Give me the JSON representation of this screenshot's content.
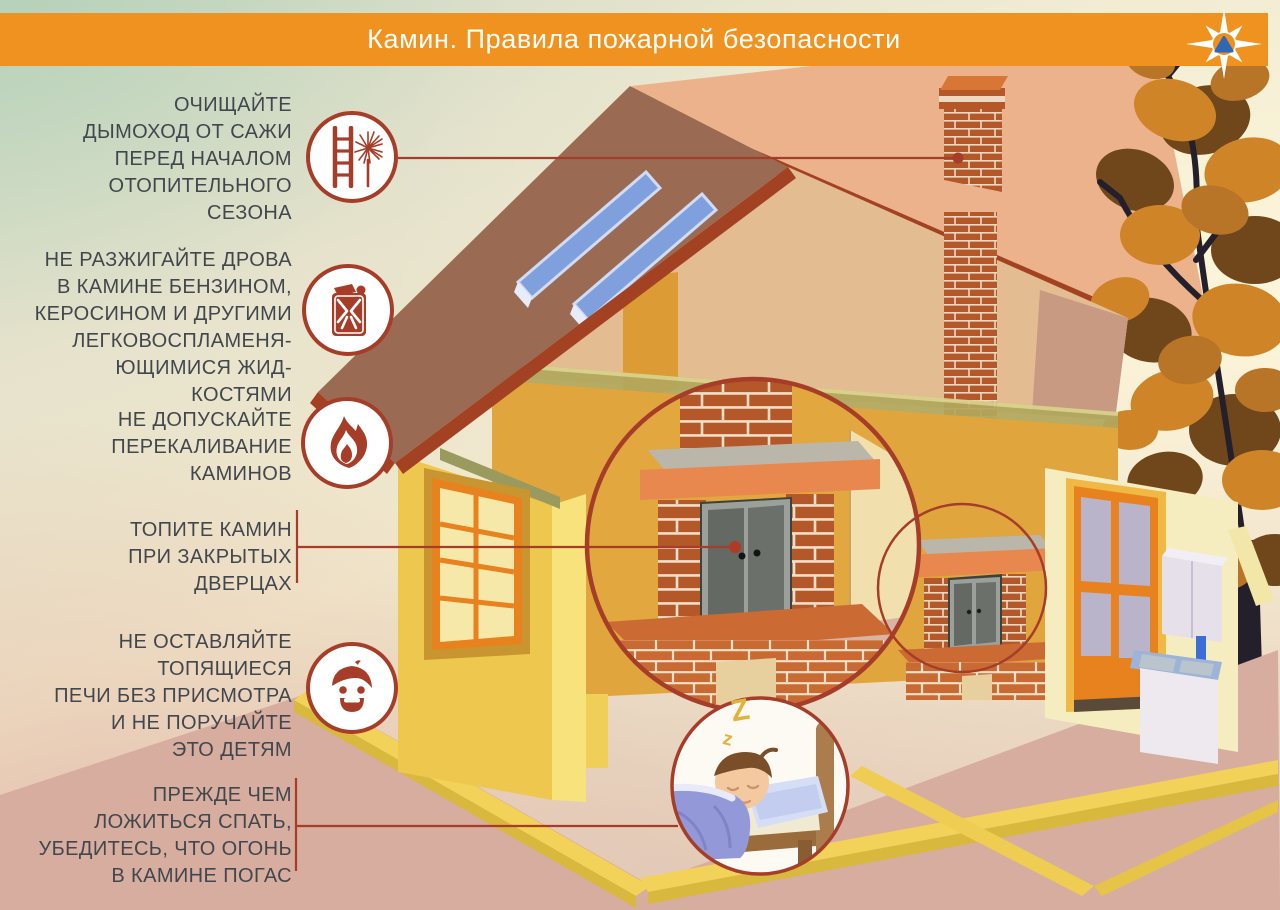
{
  "poster": {
    "title": "Камин. Правила пожарной безопасности"
  },
  "emblem": {
    "name": "mchs-compass-star-emblem"
  },
  "rules": [
    {
      "id": 1,
      "icon": "chimney-brush-ladder-icon",
      "text": "ОЧИЩАЙТЕ\nДЫМОХОД ОТ САЖИ\nПЕРЕД НАЧАЛОМ\nОТОПИТЕЛЬНОГО\nСЕЗОНА"
    },
    {
      "id": 2,
      "icon": "fuel-can-icon",
      "text": "НЕ РАЗЖИГАЙТЕ ДРОВА\nВ КАМИНЕ БЕНЗИНОМ,\nКЕРОСИНОМ И ДРУГИМИ\nЛЕГКОВОСПЛАМЕНЯ-\nЮЩИМИСЯ ЖИД-\nКОСТЯМИ"
    },
    {
      "id": 3,
      "icon": "flame-icon",
      "text": "НЕ ДОПУСКАЙТЕ\nПЕРЕКАЛИВАНИЕ\nКАМИНОВ"
    },
    {
      "id": 4,
      "icon": null,
      "text": "ТОПИТЕ КАМИН\nПРИ ЗАКРЫТЫХ\nДВЕРЦАХ"
    },
    {
      "id": 5,
      "icon": "child-face-icon",
      "text": "НЕ ОСТАВЛЯЙТЕ\nТОПЯЩИЕСЯ\nПЕЧИ БЕЗ ПРИСМОТРА\nИ НЕ ПОРУЧАЙТЕ\nЭТО ДЕТЯМ"
    },
    {
      "id": 6,
      "icon": null,
      "text": "ПРЕЖДЕ ЧЕМ\nЛОЖИТЬСЯ СПАТЬ,\nУБЕДИТЕСЬ, ЧТО ОГОНЬ\nВ КАМИНЕ ПОГАС"
    }
  ],
  "sleep_sounds": {
    "z_large": "Z",
    "z_small": "z"
  },
  "colors": {
    "banner_orange": "#f0921f",
    "accent_red": "#a63d28",
    "rule_text": "#42474d",
    "brick": "#b4582a",
    "roof_left": "#9a6a52",
    "roof_rear": "#ecb28c",
    "wall_yellow": "#eec84e",
    "wall_mustard": "#e1a53e",
    "floor_pink": "#d8b2a3",
    "solar_blue": "#7fa0dc",
    "leaf_orange": "#d08428",
    "z_yellow": "#e0b33a"
  }
}
